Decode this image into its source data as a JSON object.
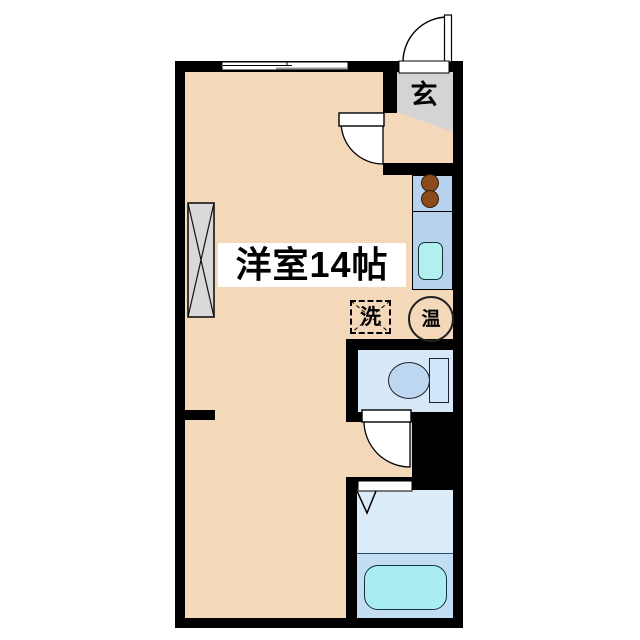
{
  "floorplan": {
    "title": "studio apartment floor plan",
    "room_label": "洋室14帖",
    "entrance_label": "玄",
    "washer_label": "洗",
    "heater_label": "温"
  },
  "colors": {
    "background": "#ffffff",
    "wall": "#000000",
    "floor_beige": "#f3d9ba",
    "genkan_gray": "#d4d4d4",
    "closet_gray": "#d9d9d9",
    "label_bg": "#ffffff",
    "kitchen_counter_blue": "#b7d2ee",
    "sink_cyan": "#b2f0f0",
    "burner_brown": "#8a4a1a",
    "toilet_floor_blue": "#d6e8f8",
    "toilet_bowl_blue": "#bed7f0",
    "toilet_tank_blue": "#cde6f8",
    "bath_floor_light": "#dcebf8",
    "bath_floor_dark": "#c3def2",
    "bathtub_cyan": "#a9edf2"
  }
}
